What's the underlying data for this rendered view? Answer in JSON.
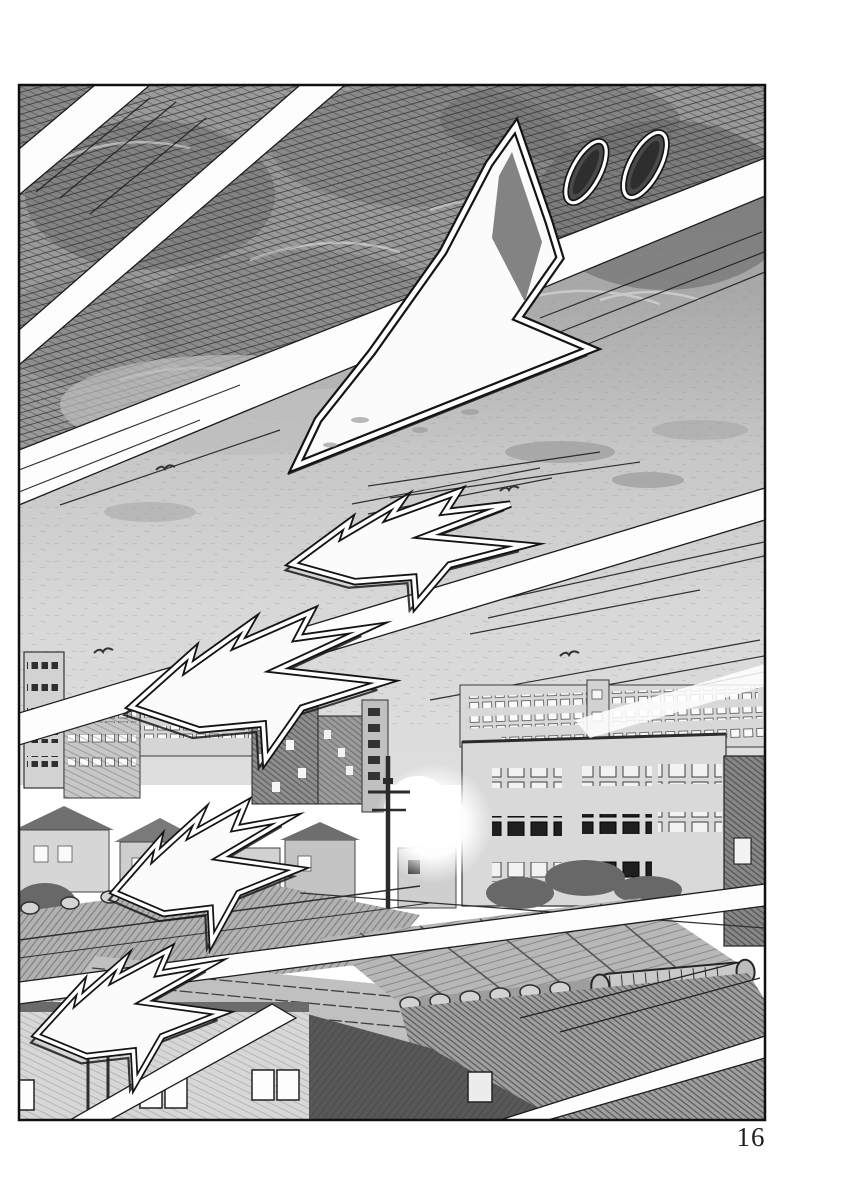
{
  "page": {
    "number": "16"
  },
  "artwork": {
    "kind": "manga-panel",
    "sfx_glyph_count": 5,
    "dakuten_mark_count": 2
  },
  "colors": {
    "paper": "#ffffff",
    "ink": "#1c1c1c",
    "sky_dark": "#8f8f8f",
    "sky_light": "#d9d9d9",
    "tone_mid": "#bdbdbd"
  }
}
